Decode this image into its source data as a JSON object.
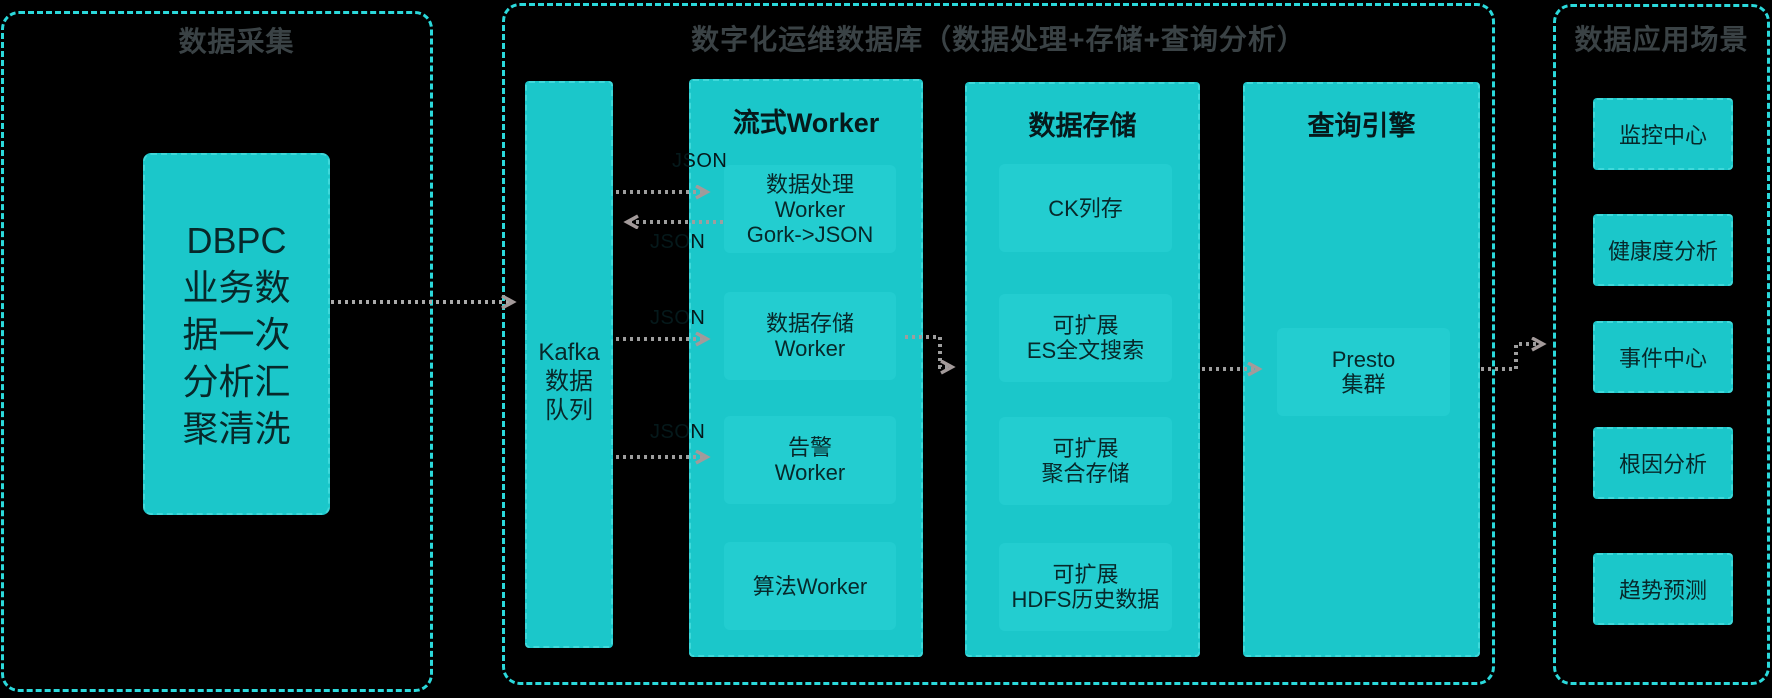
{
  "colors": {
    "background": "#000000",
    "box_fill": "#1bc7ca",
    "box_fill_inner": "#23cdd0",
    "panel_border": "#2bd9db",
    "section_title_text": "#3a4245",
    "box_text": "#07282a",
    "arrow": "#9e9e9e"
  },
  "collection": {
    "title": "数据采集",
    "dbpc_lines": [
      "DBPC",
      "业务数",
      "据一次",
      "分析汇",
      "聚清洗"
    ]
  },
  "platform": {
    "title": "数字化运维数据库（数据处理+存储+查询分析）",
    "kafka_lines": [
      "Kafka",
      "数据",
      "队列"
    ],
    "stream": {
      "title": "流式Worker",
      "items": [
        {
          "lines": [
            "数据处理",
            "Worker",
            "Gork->JSON"
          ]
        },
        {
          "lines": [
            "数据存储",
            "Worker"
          ]
        },
        {
          "lines": [
            "告警",
            "Worker"
          ]
        },
        {
          "lines": [
            "算法Worker"
          ]
        }
      ]
    },
    "storage": {
      "title": "数据存储",
      "items": [
        {
          "lines": [
            "CK列存"
          ]
        },
        {
          "lines": [
            "可扩展",
            "ES全文搜索"
          ]
        },
        {
          "lines": [
            "可扩展",
            "聚合存储"
          ]
        },
        {
          "lines": [
            "可扩展",
            "HDFS历史数据"
          ]
        }
      ]
    },
    "query": {
      "title": "查询引擎",
      "items": [
        {
          "lines": [
            "Presto",
            "集群"
          ]
        }
      ]
    }
  },
  "apps": {
    "title": "数据应用场景",
    "items": [
      "监控中心",
      "健康度分析",
      "事件中心",
      "根因分析",
      "趋势预测"
    ]
  },
  "connector_labels": [
    "JSON",
    "JSON",
    "JSON",
    "JSON"
  ]
}
